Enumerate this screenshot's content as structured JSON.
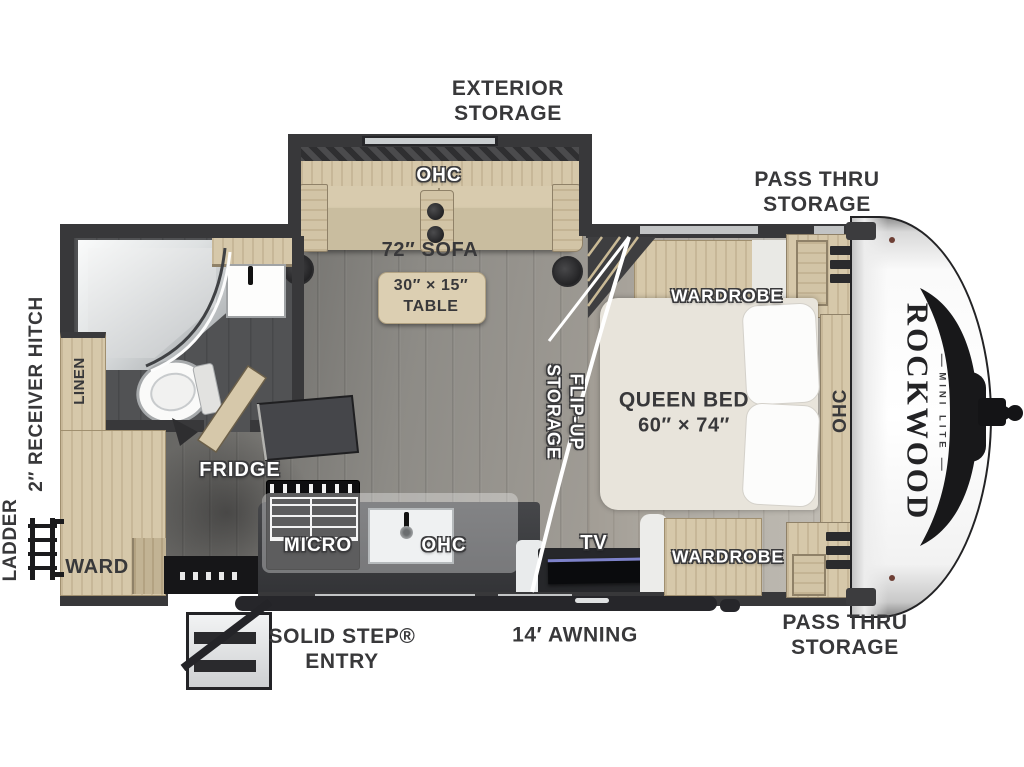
{
  "brand": {
    "name": "ROCKWOOD",
    "model": "MINI LITE"
  },
  "labels": {
    "exterior_storage": [
      "EXTERIOR",
      "STORAGE"
    ],
    "pass_thru_top": [
      "PASS THRU",
      "STORAGE"
    ],
    "pass_thru_bottom": [
      "PASS THRU",
      "STORAGE"
    ],
    "receiver_hitch": "2″ RECEIVER HITCH",
    "ladder": "LADDER",
    "solid_step_entry": [
      "SOLID STEP®",
      "ENTRY"
    ],
    "awning": "14′ AWNING",
    "slideout_ohc": "OHC",
    "sofa": "72″ SOFA",
    "table": [
      "30″ × 15″",
      "TABLE"
    ],
    "flip_up_storage": [
      "FLIP-UP",
      "STORAGE"
    ],
    "queen_bed": [
      "QUEEN BED",
      "60″ × 74″"
    ],
    "wardrobe_top": "WARDROBE",
    "wardrobe_bottom": "WARDROBE",
    "bed_ohc": "OHC",
    "tv": "TV",
    "fridge": "FRIDGE",
    "micro": "MICRO",
    "kitchen_ohc": "OHC",
    "linen": "LINEN",
    "ward": "WARD"
  },
  "colors": {
    "wall": "#38383a",
    "wood": "#d6c8aa",
    "accent": "#1b1b1d",
    "label": "#38383a"
  }
}
